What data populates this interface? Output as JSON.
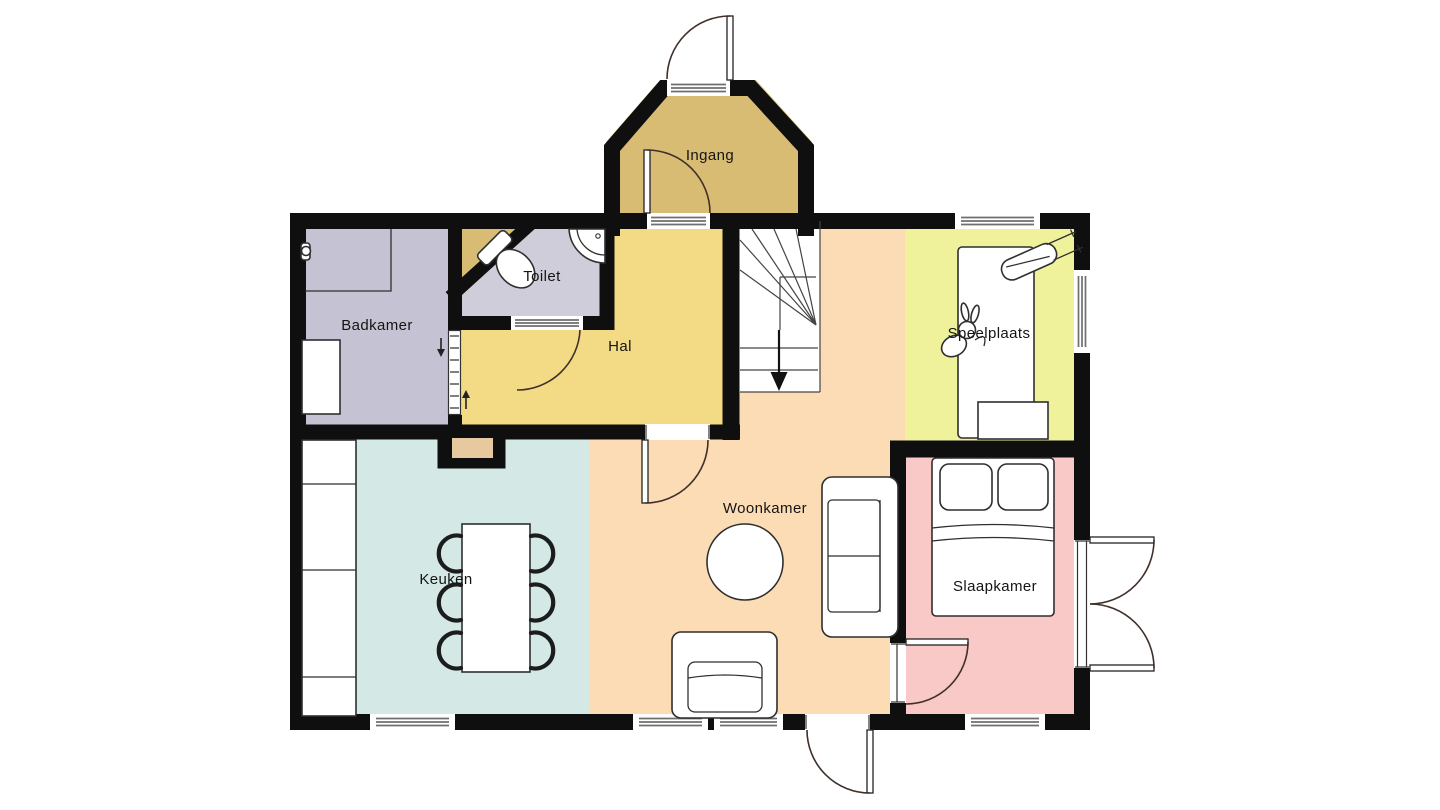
{
  "plan": {
    "background": "#ffffff",
    "wall_color": "#0f0f0f",
    "rooms": {
      "ingang": {
        "label": "Ingang",
        "color": "#d9bc74"
      },
      "hal": {
        "label": "Hal",
        "color": "#f3db86"
      },
      "toilet": {
        "label": "Toilet",
        "color": "#cfcdd9"
      },
      "badkamer": {
        "label": "Badkamer",
        "color": "#c5c3d3"
      },
      "speelplaats": {
        "label": "Speelplaats",
        "color": "#eff29b"
      },
      "woonkamer": {
        "label": "Woonkamer",
        "color": "#fbdcb5"
      },
      "keuken": {
        "label": "Keuken",
        "color": "#d4e9e6"
      },
      "slaapkamer": {
        "label": "Slaapkamer",
        "color": "#f8c9c6"
      },
      "stairs": {
        "color": "#ffffff"
      },
      "chimney": {
        "color": "#e7c9a0"
      }
    }
  }
}
